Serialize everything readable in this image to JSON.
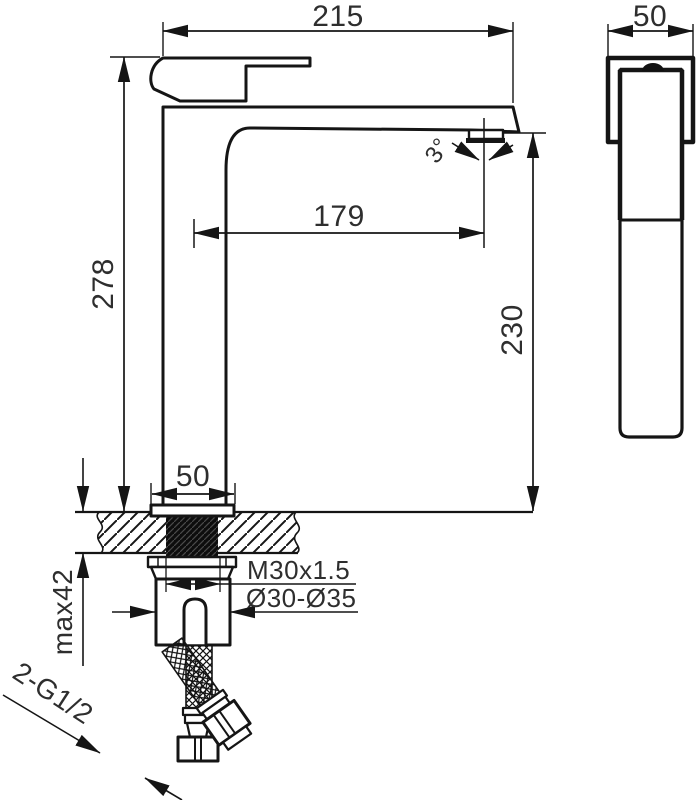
{
  "drawing": {
    "title_hint": "tall basin mixer tap technical dimension drawing",
    "line_color": "#151515",
    "background_color": "#ffffff",
    "dims": {
      "spout_width": "215",
      "body_depth": "50",
      "total_height": "278",
      "spout_height": "230",
      "spout_reach": "179",
      "spout_angle": "3°",
      "base_width": "50",
      "mounting_thread": "M30x1.5",
      "hole_diameter": "Ø30-Ø35",
      "max_counter_thickness": "max42",
      "inlet_connection": "2-G1/2"
    }
  }
}
